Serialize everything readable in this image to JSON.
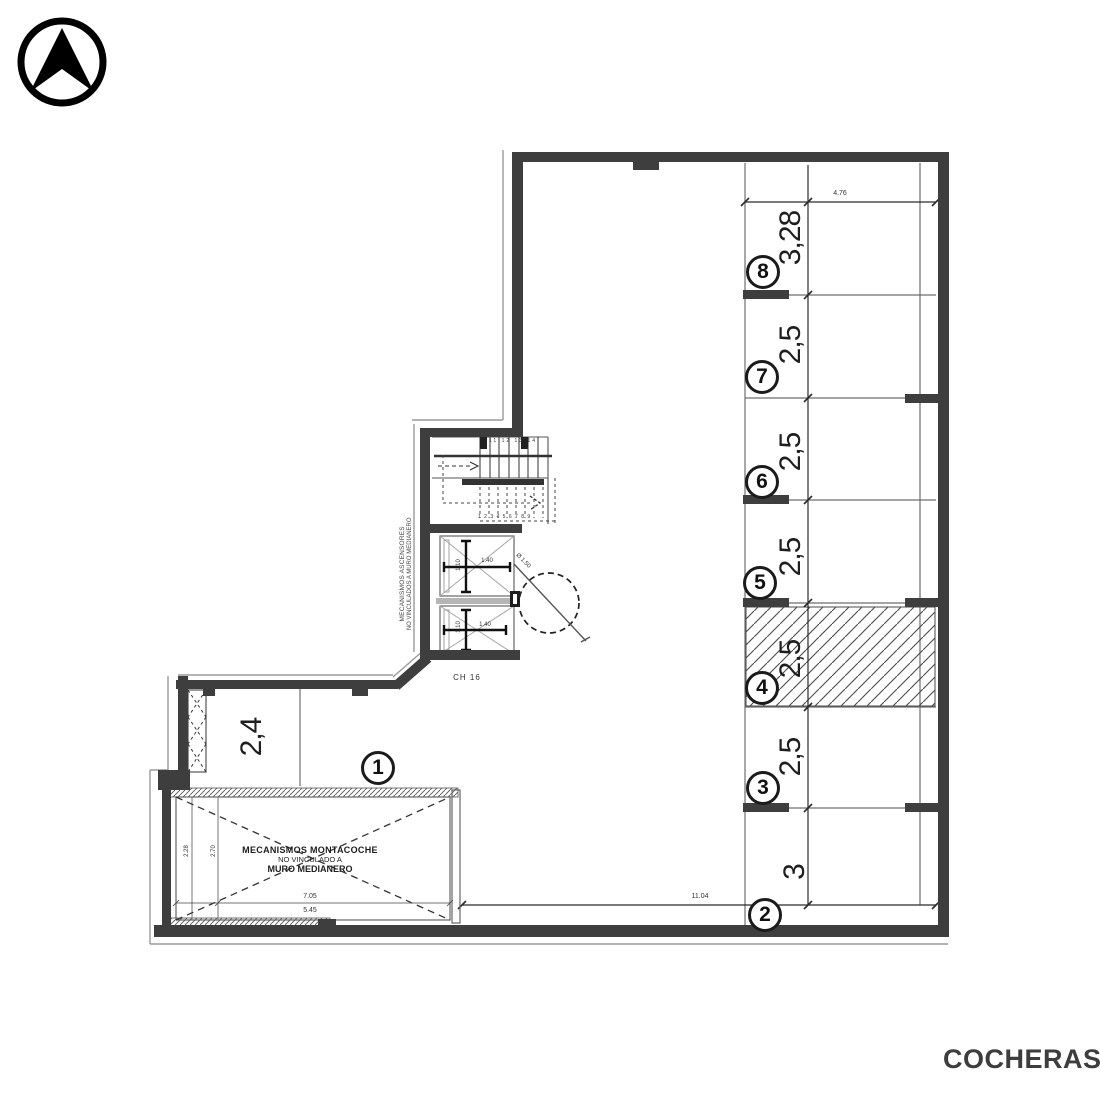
{
  "title": "COCHERAS",
  "north_arrow": {
    "icon": "north-arrow"
  },
  "parking_spaces": [
    {
      "number": "8",
      "dim": "3,28",
      "hatched": false
    },
    {
      "number": "7",
      "dim": "2,5",
      "hatched": false
    },
    {
      "number": "6",
      "dim": "2,5",
      "hatched": false
    },
    {
      "number": "5",
      "dim": "2,5",
      "hatched": false
    },
    {
      "number": "4",
      "dim": "2,5",
      "hatched": true
    },
    {
      "number": "3",
      "dim": "2,5",
      "hatched": false
    },
    {
      "number": "2",
      "dim": "3",
      "hatched": false
    },
    {
      "number": "1",
      "dim": "2,4",
      "hatched": false
    }
  ],
  "dimensions": {
    "top_overall": "4.76",
    "bottom_overall": "11.04",
    "car_lift_width": "7.05",
    "car_lift_inner": "5.45",
    "car_lift_depth_a": "2.28",
    "car_lift_depth_b": "2.70",
    "elevator_width_top": "1.40",
    "elevator_depth_top": "1.10",
    "elevator_width_bottom": "1.40",
    "elevator_depth_bottom": "1.10",
    "turning_circle": "Ø 1.50"
  },
  "labels": {
    "car_lift_line1": "MECANISMOS MONTACOCHE",
    "car_lift_line2": "NO VINCULADO A",
    "car_lift_line3": "MURO MEDIANERO",
    "elevators_note_line1": "MECANISMOS ASCENSORES",
    "elevators_note_line2": "NO VINCULADOS A MURO MEDIANERO",
    "stair_upper_treads": "11 12 13 14",
    "stair_lower_treads": "1 2 3 4 5 6 7 8 9",
    "level_label": "CH 16"
  },
  "colors": {
    "wall": "#3e3e3e",
    "line": "#777777",
    "text": "#1e1e1e"
  }
}
